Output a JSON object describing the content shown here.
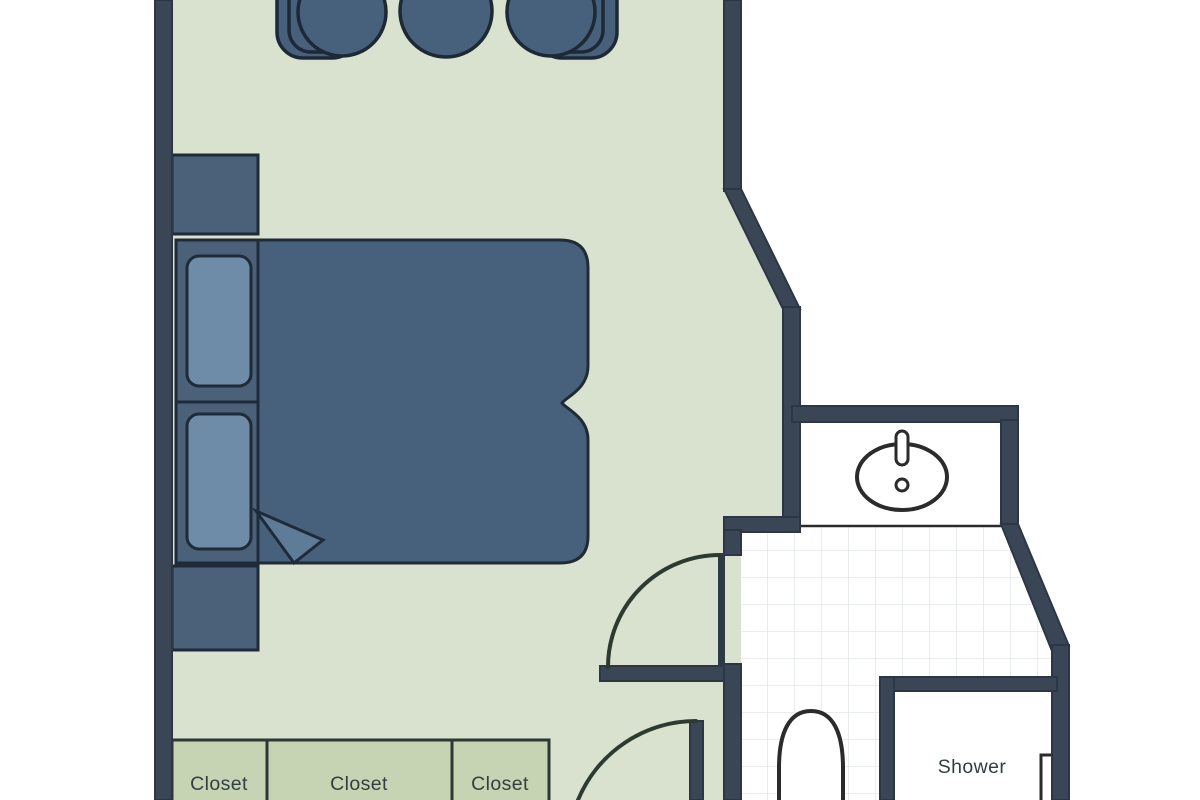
{
  "plan": {
    "type": "floor-plan",
    "description": "Hotel room floor plan cropped at top and bottom: bedroom with bed, two nightstands, three chairs, three closets; bathroom with vanity sink, toilet and shower",
    "rooms": [
      "bedroom",
      "bathroom",
      "vanity-nook",
      "shower-room",
      "entry-vestibule"
    ],
    "furniture": [
      "chair",
      "chair",
      "chair",
      "nightstand",
      "bed",
      "pillow",
      "pillow",
      "duvet-fold",
      "nightstand",
      "closet",
      "closet",
      "closet",
      "sink",
      "toilet",
      "shower-door"
    ]
  },
  "labels": {
    "closet_1": "Closet",
    "closet_2": "Closet",
    "closet_3": "Closet",
    "shower": "Shower"
  },
  "colors": {
    "background": "#ffffff",
    "floor": "#d8e2ce",
    "closet": "#c7d4b4",
    "wall": "#3a4656",
    "furniture_dark": "#47617c",
    "furniture_mid": "#4a6179",
    "pillow": "#6e8ba7",
    "fold": "#5e7b98",
    "door_leaf": "#2e3946",
    "tile_line": "#e4e7ea",
    "room_white": "#ffffff",
    "fixture_outline": "#2b2b2b",
    "door_arc": "#2d3a32",
    "label_text": "#333e41"
  }
}
